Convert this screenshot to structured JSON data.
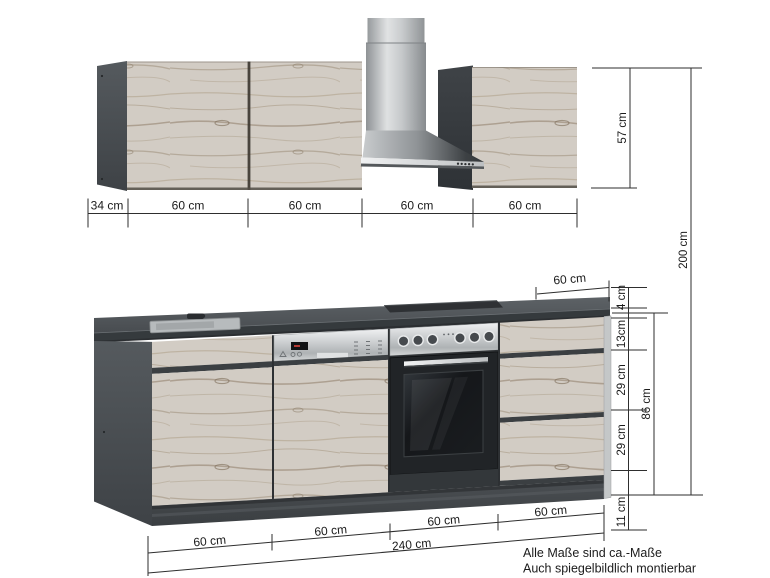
{
  "diagram": {
    "dimensions": {
      "top_row": [
        "34 cm",
        "60 cm",
        "60 cm",
        "60 cm",
        "60 cm"
      ],
      "upper_cabinet_height": "57 cm",
      "total_height": "200 cm",
      "worktop_depth": "60 cm",
      "right_chain": [
        "4 cm",
        "13cm",
        "29 cm",
        "29 cm",
        "11 cm"
      ],
      "base_unit_height": "86 cm",
      "bottom_row": [
        "60 cm",
        "60 cm",
        "60 cm",
        "60 cm"
      ],
      "total_width": "240 cm"
    },
    "footnote": {
      "line1": "Alle Maße sind ca.-Maße",
      "line2": "Auch spiegelbildlich montierbar"
    },
    "colors": {
      "background": "#ffffff",
      "anthracite": "#3f4347",
      "wood": "#d2ccc4",
      "stainless": "#d5d7d8",
      "worktop": "#4b5054",
      "dimension_line": "#2e2e2e",
      "text": "#1b1b1b"
    }
  }
}
